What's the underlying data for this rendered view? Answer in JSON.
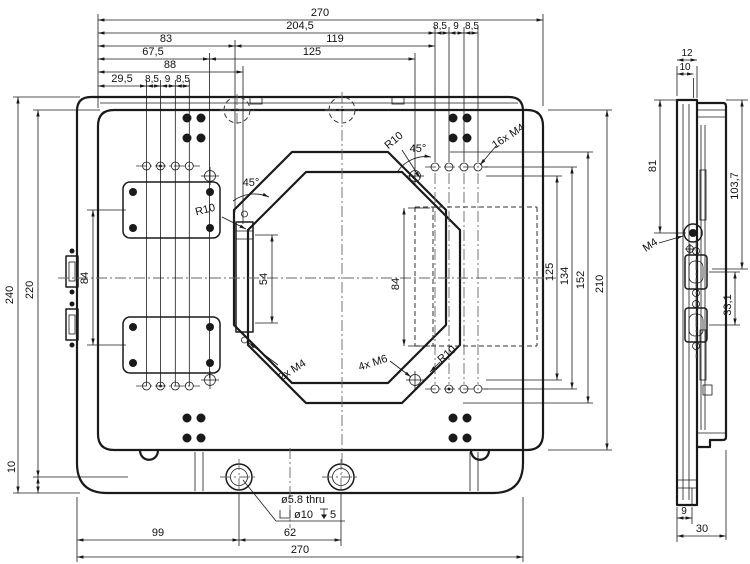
{
  "colors": {
    "ink": "#1a1a1a",
    "centerline": "#666666",
    "background": "#ffffff"
  },
  "front_view": {
    "dims_top": {
      "overall": "270",
      "outer_chain": "204,5",
      "pitch1": "8,5",
      "pitch2": "9",
      "pitch3": "8,5",
      "left_83": "83",
      "mid_119": "119",
      "left_675": "67,5",
      "mid_125": "125",
      "left_88": "88",
      "left_295": "29,5"
    },
    "dims_left": {
      "height": "240",
      "inner_height": "220",
      "cover_pitch": "84",
      "base_step": "10"
    },
    "dims_right": {
      "m6_pitch": "125",
      "hole_rows": "134",
      "cutout": "152",
      "plate": "210"
    },
    "dims_inner": {
      "slot": "54",
      "pocket": "84"
    },
    "dims_bottom": {
      "edge_99": "99",
      "hole_62": "62",
      "overall": "270"
    },
    "hole_note": {
      "line1": "ø5.8 thru",
      "cbore_dia": "ø10",
      "cbore_depth": "5"
    },
    "leaders": {
      "radius": "R10",
      "angle": "45°",
      "m4_16": "16x M4",
      "m4_2": "2x M4",
      "m6_4": "4x M6"
    }
  },
  "side_view": {
    "dims": {
      "top_12": "12",
      "top_10": "10",
      "left_81": "81",
      "right_1037": "103,7",
      "conn_331": "33,1",
      "bot_9": "9",
      "bot_30": "30"
    },
    "leaders": {
      "m4": "M4"
    }
  }
}
